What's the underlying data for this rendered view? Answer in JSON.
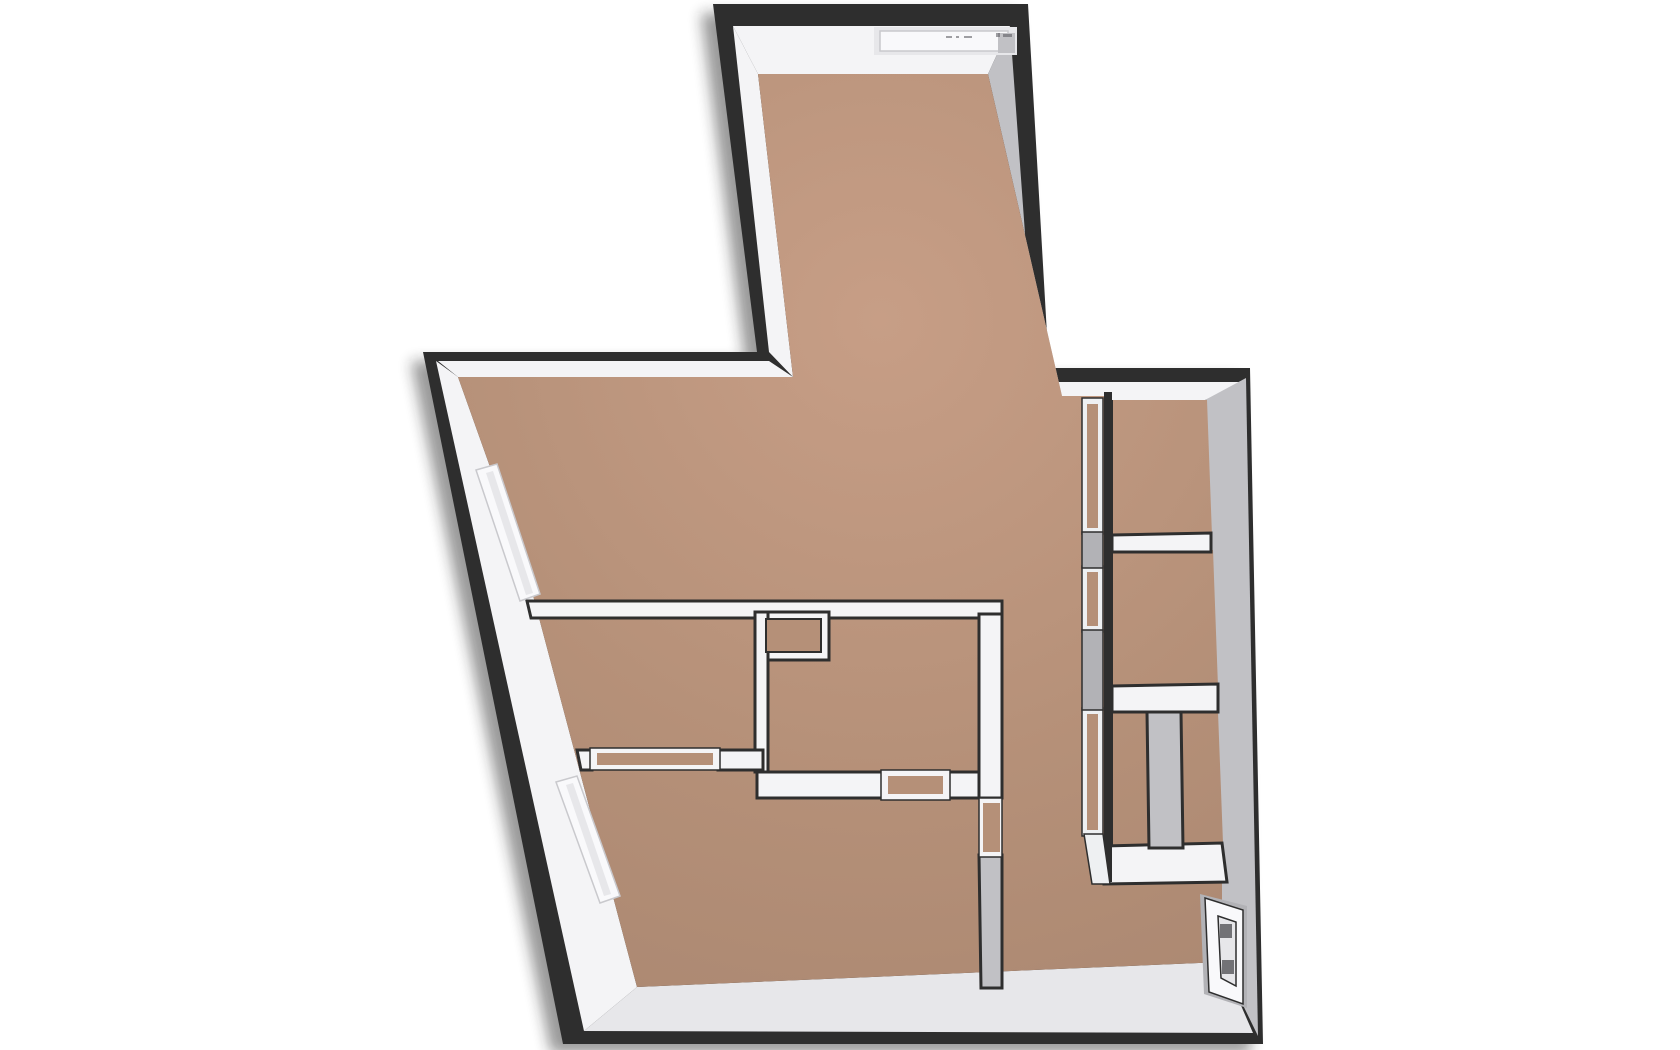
{
  "floorplan": {
    "colors": {
      "background": "#ffffff",
      "outline": "#2e2e2e",
      "shadow": "#1c1c1c",
      "floor_light": "#c79e86",
      "floor_mid": "#b59078",
      "floor_dark": "#a98670",
      "wall_white": "#f4f4f6",
      "wall_white_dim": "#e7e7ea",
      "wall_gray": "#c1c1c5",
      "wall_gray_dark": "#b2b2b6",
      "glass_white": "#eef0f2",
      "door_white": "#f9f9fb",
      "door_mark": "#55555a"
    },
    "features": {
      "windows": 3,
      "entry_doors": 1,
      "wall_openings": 3,
      "closed_shafts": 1
    }
  }
}
